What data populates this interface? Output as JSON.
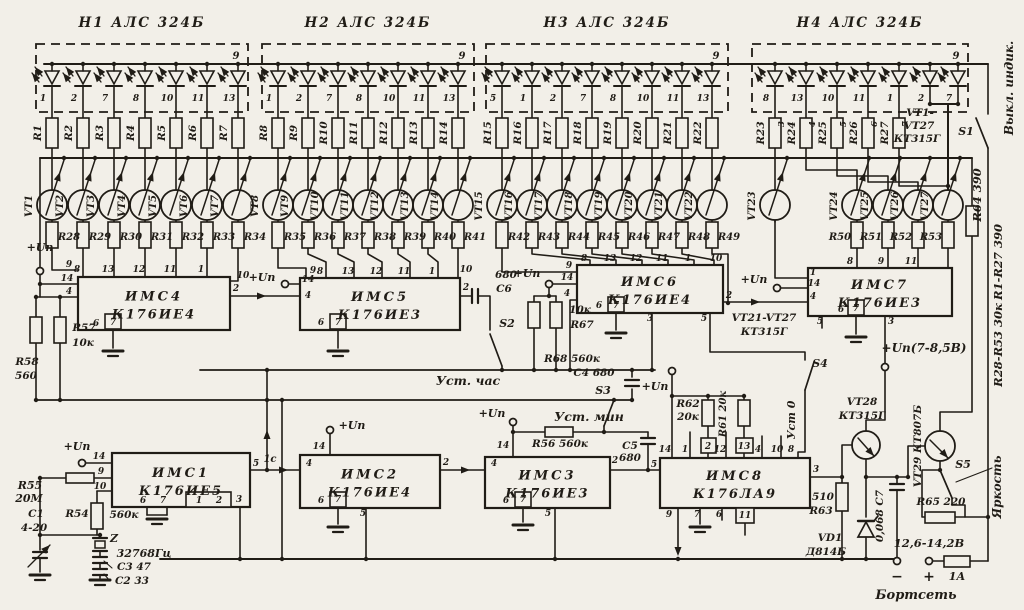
{
  "palette": {
    "paper": "#f2efe8",
    "ink": "#201c16"
  },
  "displays": [
    {
      "name": "Н1  АЛС 324Б",
      "common_pin": "9",
      "led_pins": [
        "1",
        "2",
        "7",
        "8",
        "10",
        "11",
        "13"
      ]
    },
    {
      "name": "Н2  АЛС 324Б",
      "common_pin": "9",
      "led_pins": [
        "1",
        "2",
        "7",
        "8",
        "10",
        "11",
        "13"
      ]
    },
    {
      "name": "Н3  АЛС 324Б",
      "common_pin": "9",
      "led_pins": [
        "5",
        "1",
        "2",
        "7",
        "8",
        "10",
        "11",
        "13"
      ]
    },
    {
      "name": "Н4  АЛС 324Б",
      "common_pin": "9",
      "led_pins": [
        "8",
        "13",
        "10",
        "11",
        "1",
        "2",
        "7"
      ]
    }
  ],
  "segment_resistors": [
    "R1",
    "R2",
    "R3",
    "R4",
    "R5",
    "R6",
    "R7",
    "R8",
    "R9",
    "R10",
    "R11",
    "R12",
    "R13",
    "R14",
    "R15",
    "R16",
    "R17",
    "R18",
    "R19",
    "R20",
    "R21",
    "R22",
    "R23",
    "R24",
    "R25",
    "R26",
    "R27"
  ],
  "wire_tags": [
    "3",
    "4",
    "5",
    "6",
    "7"
  ],
  "transistors": [
    "VT1",
    "VT2",
    "VT3",
    "VT4",
    "VT5",
    "VT6",
    "VT7",
    "VT8",
    "VT9",
    "VT10",
    "VT11",
    "VT12",
    "VT13",
    "VT14",
    "VT15",
    "VT16",
    "VT17",
    "VT18",
    "VT19",
    "VT20",
    "VT21",
    "VT22",
    "VT23",
    "VT24",
    "VT25",
    "VT26",
    "VT27"
  ],
  "base_resistors": [
    "R28",
    "R29",
    "R30",
    "R31",
    "R32",
    "R33",
    "R34",
    "R35",
    "R36",
    "R37",
    "R38",
    "R39",
    "R40",
    "R41",
    "R42",
    "R43",
    "R44",
    "R45",
    "R46",
    "R47",
    "R48",
    "R49",
    "R50",
    "R51",
    "R52",
    "R53"
  ],
  "chips": [
    {
      "label": "ИМС4",
      "part": "К176ИЕ4",
      "top": [
        "8",
        "13",
        "12",
        "11",
        "1"
      ],
      "left": [
        "9",
        "14",
        "4"
      ],
      "right": [
        "10",
        "2"
      ],
      "bottom": [
        "6",
        "7"
      ]
    },
    {
      "label": "ИМС5",
      "part": "К176ИЕ3",
      "top": [
        "9",
        "8",
        "13",
        "12",
        "11",
        "1",
        "10"
      ],
      "left": [
        "14",
        "4"
      ],
      "right": [
        "2"
      ],
      "bottom": [
        "6",
        "7"
      ]
    },
    {
      "label": "ИМС6",
      "part": "К176ИЕ4",
      "top": [
        "8",
        "13",
        "12",
        "11",
        "1",
        "10"
      ],
      "left": [
        "9",
        "14",
        "4"
      ],
      "right": [
        "2"
      ],
      "bottom": [
        "6",
        "7",
        "3",
        "5"
      ]
    },
    {
      "label": "ИМС7",
      "part": "К176ИЕ3",
      "top": [
        "8",
        "9",
        "11"
      ],
      "left": [
        "1",
        "14",
        "4"
      ],
      "right": [],
      "bottom": [
        "5",
        "6",
        "7",
        "3"
      ]
    },
    {
      "label": "ИМС1",
      "part": "К176ИЕ5",
      "top": [],
      "left": [
        "14",
        "9",
        "10"
      ],
      "right": [
        "5"
      ],
      "bottom": [
        "6",
        "7",
        "1",
        "2",
        "3"
      ]
    },
    {
      "label": "ИМС2",
      "part": "К176ИЕ4",
      "top": [
        "14"
      ],
      "left": [
        "4"
      ],
      "right": [
        "2"
      ],
      "bottom": [
        "6",
        "7",
        "5"
      ]
    },
    {
      "label": "ИМС3",
      "part": "К176ИЕ3",
      "top": [
        "14"
      ],
      "left": [
        "4"
      ],
      "right": [
        "2"
      ],
      "bottom": [
        "6",
        "7",
        "5"
      ]
    },
    {
      "label": "ИМС8",
      "part": "К176ЛА9",
      "top": [
        "14",
        "1",
        "2",
        "12",
        "13",
        "4",
        "10",
        "8"
      ],
      "left": [
        "5"
      ],
      "right": [
        "3"
      ],
      "bottom": [
        "9",
        "7",
        "6",
        "11"
      ]
    }
  ],
  "labels": {
    "u_p": "+Uп",
    "u_p_high": "+Uп(7-8,5В)",
    "set_hours": "Уст. час",
    "set_min": "Уст. мин",
    "set_zero": "Уст 0",
    "display_off": "Выкл. индик.",
    "brightness": "Яркость",
    "board_net": "Бортсеть",
    "voltage_range": "12,6-14,2В",
    "fuse": "1А",
    "minus": "−",
    "plus": "+",
    "one_sec": "1с",
    "note_r64": "R64 390",
    "note_r1_r27": "R1-R27 390",
    "note_r28_r53": "R28-R53 30к",
    "vt_right": [
      "VT1-",
      "VT27",
      "КТ315Г"
    ],
    "vt_mid": [
      "VT21-VT27",
      "КТ315Г"
    ]
  },
  "components": {
    "r55": [
      "R55",
      "20М"
    ],
    "r54": [
      "R54",
      "560к"
    ],
    "c1": [
      "С1",
      "4-20"
    ],
    "quartz": [
      "Z",
      "32768Гц"
    ],
    "c3": "С3 47",
    "c2": "С2 33",
    "r57": [
      "R57",
      "10к"
    ],
    "r58": [
      "R58",
      "560"
    ],
    "c6": [
      "680",
      "С6"
    ],
    "s2": "S2",
    "c4": "C4 680",
    "s3": "S3",
    "r56": "R56 560к",
    "r67": [
      "10к",
      "R67"
    ],
    "r68": "R68 560к",
    "c5": [
      "С5",
      "680"
    ],
    "r62": [
      "R62",
      "20к"
    ],
    "r61": "R61 20к",
    "s4": "S4",
    "s1": "S1",
    "s5": "S5",
    "r63": [
      "510",
      "R63"
    ],
    "vd1": [
      "VD1",
      "Д814Б"
    ],
    "vt28": [
      "VT28",
      "КТ315Г"
    ],
    "vt29": "VT29 КТ807Б",
    "c7": "0,068 С7",
    "r65": "R65 220"
  }
}
